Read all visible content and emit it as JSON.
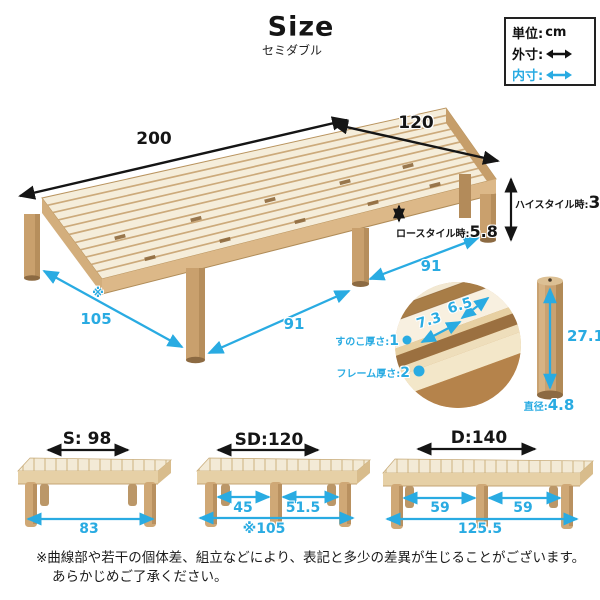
{
  "colors": {
    "accent_blue": "#29abe2",
    "ink": "#1a1a1a",
    "wood_frame": "#d9b888",
    "wood_slat": "#f5edda",
    "wood_leg": "#c9a06d"
  },
  "header": {
    "title": "Size",
    "subtitle": "セミダブル"
  },
  "legend": {
    "unit_label": "単位:",
    "unit_value": "cm",
    "outer_label": "外寸:",
    "inner_label": "内寸:"
  },
  "main_bed": {
    "outer_length": "200",
    "outer_width": "120",
    "high_style_label": "ハイスタイル時:",
    "high_style_value": "33",
    "low_style_label": "ロースタイル時:",
    "low_style_value": "5.8",
    "leg_span_note": "※",
    "leg_span_width": "105",
    "front_gap_left": "91",
    "front_gap_right": "91"
  },
  "slat_detail": {
    "slat_width": "7.3",
    "slat_gap": "6.5",
    "slat_thickness_label": "すのこ厚さ:",
    "slat_thickness_value": "1",
    "frame_thickness_label": "フレーム厚さ:",
    "frame_thickness_value": "2"
  },
  "leg_detail": {
    "height": "27.1",
    "diameter_label": "直径:",
    "diameter_value": "4.8"
  },
  "variants": [
    {
      "label": "S: 98",
      "bottom_span": "83"
    },
    {
      "label": "SD:120",
      "gap_left": "45",
      "gap_right": "51.5",
      "bottom_span": "※105"
    },
    {
      "label": "D:140",
      "gap_left": "59",
      "gap_right": "59",
      "bottom_span": "125.5"
    }
  ],
  "note": {
    "line1": "※曲線部や若干の個体差、組立などにより、表記と多少の差異が生じることがございます。",
    "line2": "あらかじめご了承ください。"
  }
}
